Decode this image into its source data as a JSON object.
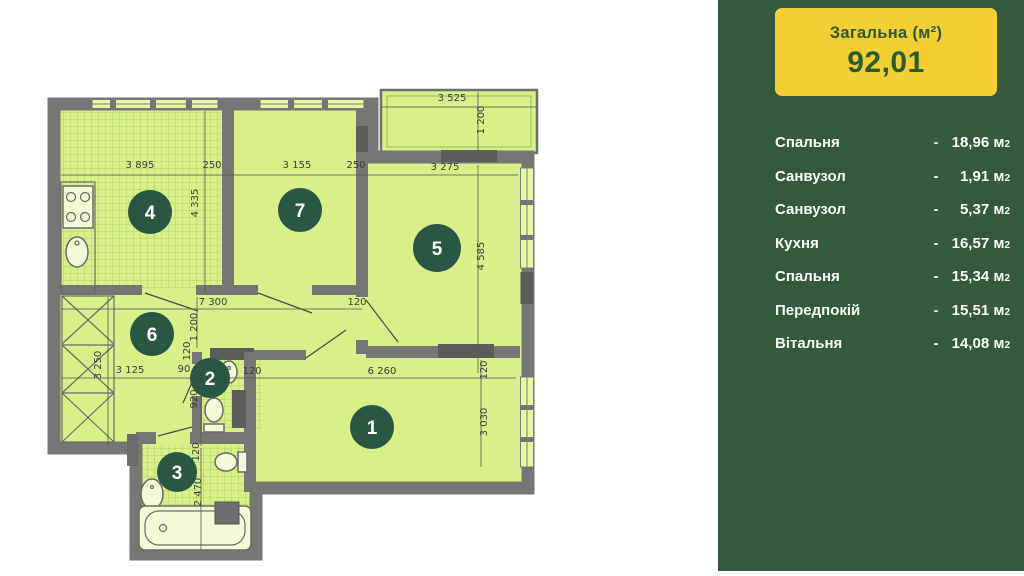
{
  "colors": {
    "panel_bg": "#34593d",
    "card_bg": "#f3cf33",
    "card_text": "#2c5a33",
    "badge": "#2b5644",
    "room_fill": "#d9ef88",
    "wall": "#767676"
  },
  "panel": {
    "total_label": "Загальна (м²)",
    "total_value": "92,01",
    "dash": "-",
    "unit": "м",
    "unit_sup": "2",
    "rooms": [
      {
        "name": "Спальня",
        "value": "18,96"
      },
      {
        "name": "Санвузол",
        "value": "1,91"
      },
      {
        "name": "Санвузол",
        "value": "5,37"
      },
      {
        "name": "Кухня",
        "value": "16,57"
      },
      {
        "name": "Спальня",
        "value": "15,34"
      },
      {
        "name": "Передпокій",
        "value": "15,51"
      },
      {
        "name": "Вітальня",
        "value": "14,08"
      }
    ]
  },
  "plan": {
    "badges": [
      {
        "n": "1",
        "x": 372,
        "y": 427,
        "r": 22
      },
      {
        "n": "2",
        "x": 210,
        "y": 378,
        "r": 20
      },
      {
        "n": "3",
        "x": 177,
        "y": 472,
        "r": 20
      },
      {
        "n": "4",
        "x": 150,
        "y": 212,
        "r": 22
      },
      {
        "n": "5",
        "x": 437,
        "y": 248,
        "r": 24
      },
      {
        "n": "6",
        "x": 152,
        "y": 334,
        "r": 22
      },
      {
        "n": "7",
        "x": 300,
        "y": 210,
        "r": 22
      }
    ],
    "dims": [
      {
        "t": "3 895",
        "x": 140,
        "y": 168
      },
      {
        "t": "250",
        "x": 212,
        "y": 168
      },
      {
        "t": "3 155",
        "x": 297,
        "y": 168
      },
      {
        "t": "250",
        "x": 356,
        "y": 168
      },
      {
        "t": "3 275",
        "x": 445,
        "y": 170
      },
      {
        "t": "3 525",
        "x": 452,
        "y": 101
      },
      {
        "t": "1 200",
        "x": 484,
        "y": 120,
        "r": 1
      },
      {
        "t": "4 335",
        "x": 198,
        "y": 203,
        "r": 1
      },
      {
        "t": "4 585",
        "x": 484,
        "y": 256,
        "r": 1
      },
      {
        "t": "7 300",
        "x": 213,
        "y": 305
      },
      {
        "t": "120",
        "x": 357,
        "y": 305
      },
      {
        "t": "1 200",
        "x": 197,
        "y": 327,
        "r": 1
      },
      {
        "t": "120",
        "x": 190,
        "y": 351,
        "r": 1
      },
      {
        "t": "3 250",
        "x": 101,
        "y": 365,
        "r": 1
      },
      {
        "t": "3 125",
        "x": 130,
        "y": 373
      },
      {
        "t": "90",
        "x": 184,
        "y": 372
      },
      {
        "t": "920",
        "x": 197,
        "y": 399,
        "r": 1
      },
      {
        "t": "120",
        "x": 252,
        "y": 374
      },
      {
        "t": "6 260",
        "x": 382,
        "y": 374
      },
      {
        "t": "120",
        "x": 487,
        "y": 370,
        "r": 1
      },
      {
        "t": "3 030",
        "x": 487,
        "y": 422,
        "r": 1
      },
      {
        "t": "120",
        "x": 199,
        "y": 452,
        "r": 1
      },
      {
        "t": "2 470",
        "x": 201,
        "y": 492,
        "r": 1
      }
    ]
  }
}
